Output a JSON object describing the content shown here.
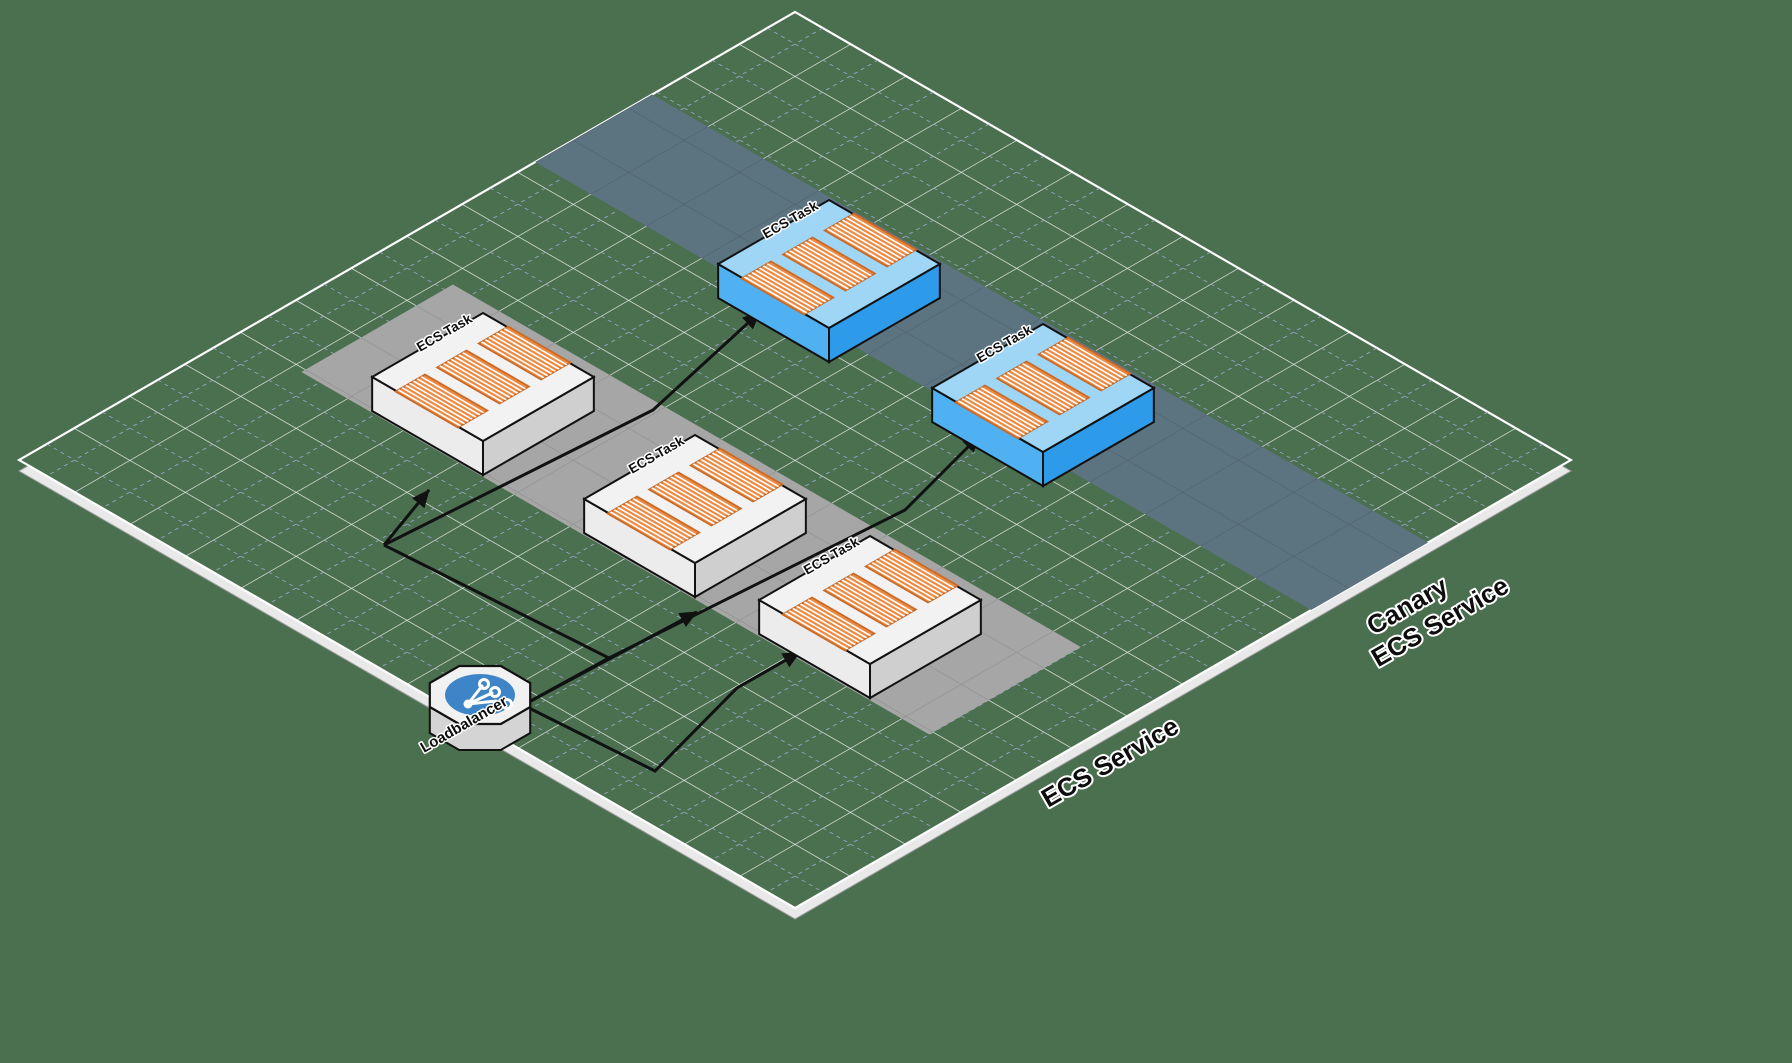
{
  "diagram_title": "ECS canary deployment isometric diagram",
  "colors": {
    "background": "#4B7050",
    "plane_green": "#4B7050",
    "plane_edge_slab": "#E9E9E9",
    "grid_white": "#FFFFFF",
    "grid_dashed": "#A8AED8",
    "band_gray": "#A6A6A6",
    "band_canary": "#5C7380",
    "box_white_top": "#F2F2F2",
    "box_white_left": "#ECECEC",
    "box_white_right": "#CFCFCF",
    "box_blue_top": "#9FD6F6",
    "box_blue_left": "#4FB0F2",
    "box_blue_right": "#2D9BE9",
    "container_orange": "#ED8A42",
    "container_outline": "#C86A28",
    "loadbalancer_circle": "#3D85C6",
    "arrow": "#111111"
  },
  "labels": {
    "ecs_task": "ECS Task",
    "loadbalancer": "Loadbalancer"
  },
  "bands": {
    "ecs_service": {
      "label": "ECS Service"
    },
    "canary": {
      "label_line1": "Canary",
      "label_line2": "ECS Service"
    }
  },
  "nodes": {
    "white_ecs_tasks": 3,
    "canary_ecs_tasks": 2,
    "loadbalancers": 1,
    "arrows": 5
  }
}
